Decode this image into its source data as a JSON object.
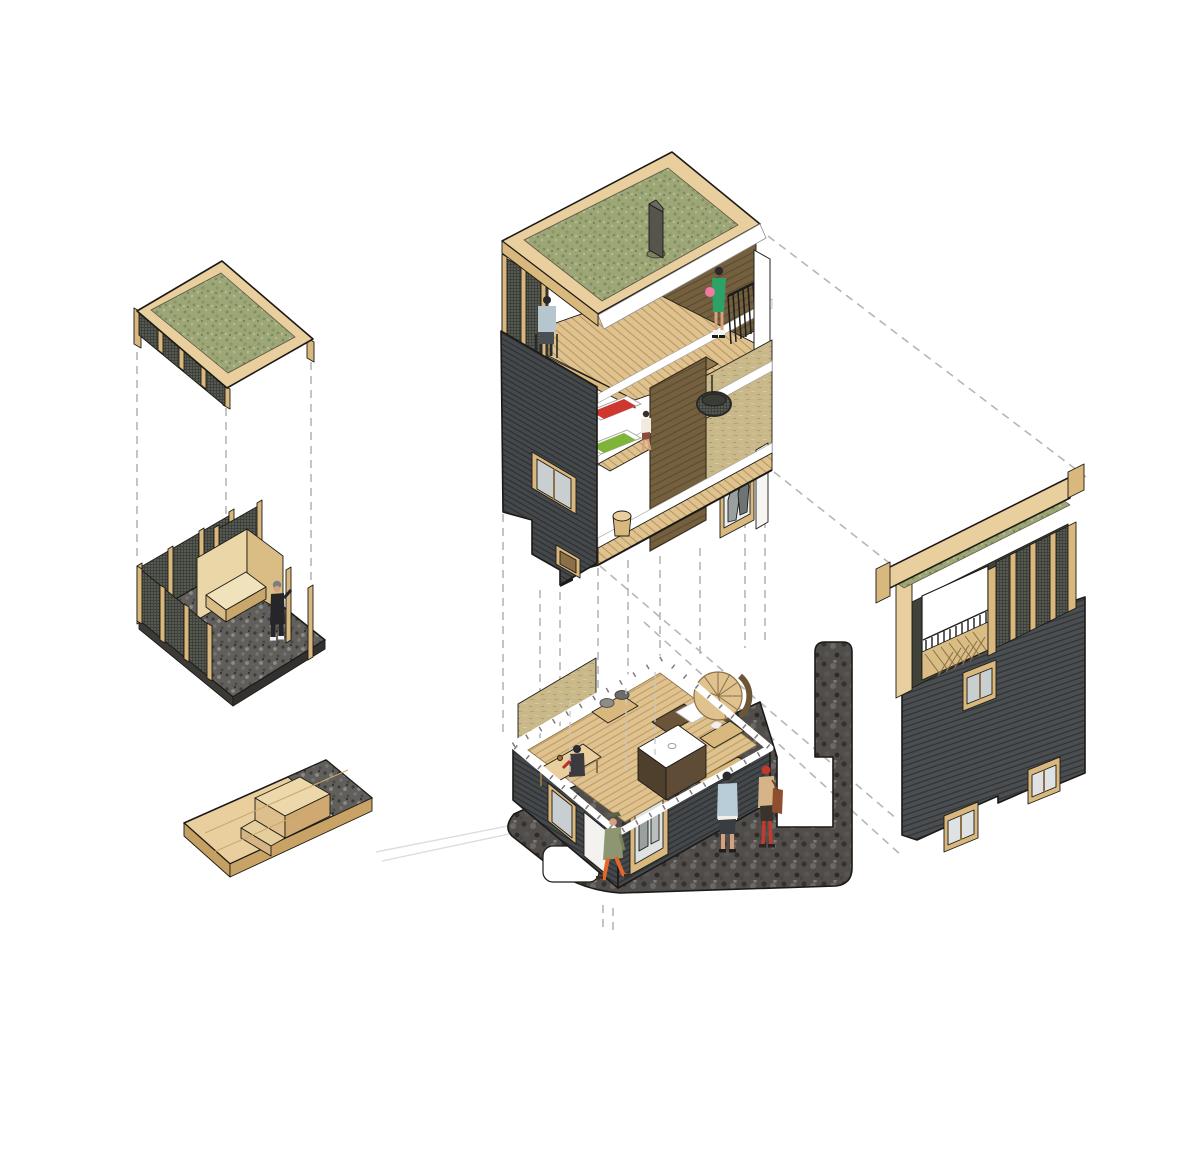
{
  "meta": {
    "title": "exploded-axonometric-cabin-tower-diagram",
    "canvas": {
      "width": 1200,
      "height": 1170,
      "background": "#ffffff"
    }
  },
  "palette": {
    "grass_base": "#9ca677",
    "grass_dark": "#7f8c5c",
    "grass_light": "#b6bd90",
    "wood_face": "#e9cf9d",
    "wood_side": "#d9b87e",
    "wood_shade": "#c5a063",
    "plywood": "#ead6a6",
    "plywood_side": "#d9bd85",
    "slat_base": "#44484b",
    "slat_line": "#2d3033",
    "mesh_base": "#565a52",
    "mesh_line": "#3a3d35",
    "gravel_base": "#615f5b",
    "cobble_base": "#504d4a",
    "deck_base": "#e0c28f",
    "deck_line": "#b3945f",
    "core_base": "#74603f",
    "core_line": "#5a4a2d",
    "straw_base": "#c9b88a",
    "white": "#ffffff",
    "railing_black": "#1c1c1c",
    "mattress_red": "#cd372e",
    "mattress_green": "#7fb43a",
    "glass": "#c9ced1",
    "dash_gray": "#b6b6b6",
    "skin": "#d6a17e"
  },
  "components": [
    {
      "id": "exploded-roof-panel",
      "name": "green-roof-module"
    },
    {
      "id": "construction-room",
      "name": "wall-framing-module"
    },
    {
      "id": "foundation-deck",
      "name": "timber-plinth-module"
    },
    {
      "id": "tower-cutaway",
      "name": "tower-section-module"
    },
    {
      "id": "ground-floor-plan",
      "name": "ground-floor-module"
    },
    {
      "id": "facade-elevation",
      "name": "street-facade-module"
    }
  ],
  "figures": {
    "builder": {
      "outfit": "#26262a",
      "cap": "#7d7d80",
      "shoes": "#f2f2f0"
    },
    "balcony_sitter": {
      "shirt": "#b5c6ce",
      "hair": "#2a2a2e"
    },
    "green_dress_woman": {
      "dress": "#2ca266",
      "bag": "#ef7ca0",
      "hair": "#2a2a2e"
    },
    "child": {
      "shirt": "#f1ebdf",
      "shorts": "#8a4a3c"
    },
    "walker": {
      "coat": "#8e9671",
      "pants": "#e0682c",
      "hat": "#5c6147"
    },
    "blue_shirt_man": {
      "shirt": "#b9cdd8",
      "shorts": "#383d41",
      "hair": "#2a2a2e"
    },
    "red_tights_woman": {
      "top": "#d6b488",
      "skirt": "#3a332d",
      "tights": "#c23a30",
      "hair": "#bf3a2a",
      "bag": "#8f4f2e"
    },
    "table_sitter": {
      "top": "#3c3a3e",
      "accent": "#b23327"
    }
  }
}
